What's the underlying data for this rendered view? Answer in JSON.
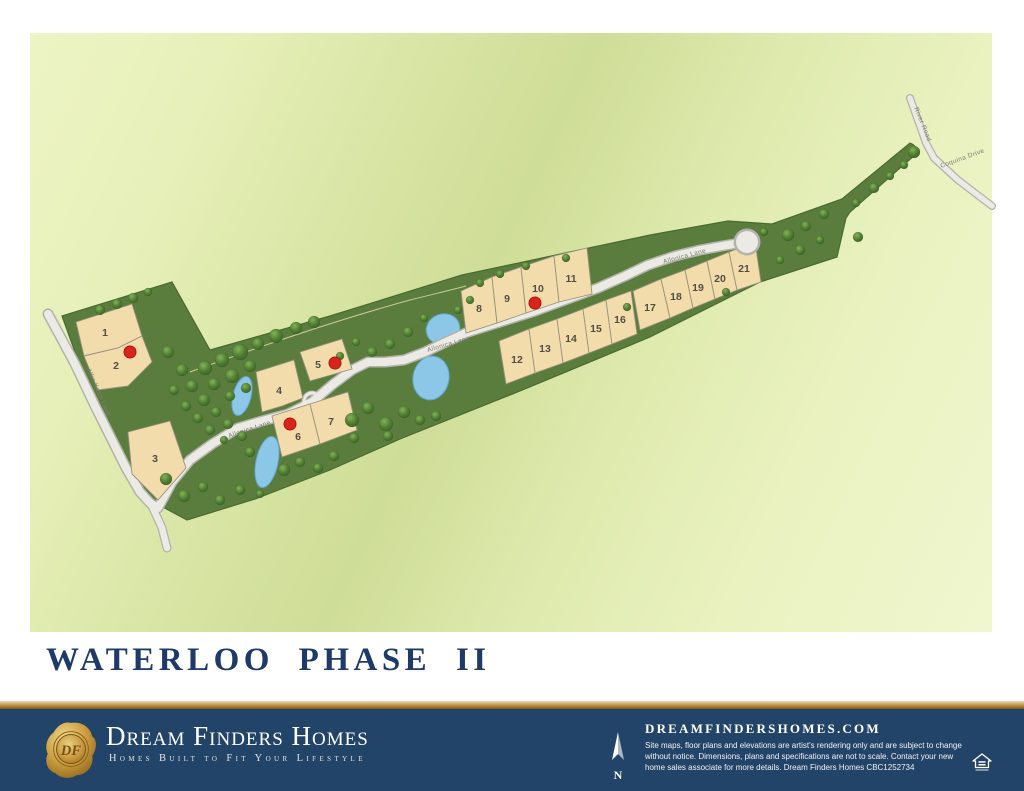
{
  "title": "WATERLOO PHASE II",
  "map": {
    "street_labels": [
      {
        "text": "Allie Koon Lane",
        "x": 97,
        "y": 393,
        "rotate": 66
      },
      {
        "text": "Allonica Lane",
        "x": 250,
        "y": 431,
        "rotate": -18
      },
      {
        "text": "Allonica Lane",
        "x": 449,
        "y": 346,
        "rotate": -16
      },
      {
        "text": "Allonica Lane",
        "x": 685,
        "y": 258,
        "rotate": -15
      },
      {
        "text": "River Road",
        "x": 921,
        "y": 125,
        "rotate": 68
      },
      {
        "text": "Coquina Drive",
        "x": 963,
        "y": 160,
        "rotate": -20
      }
    ],
    "lots": [
      {
        "n": "1",
        "x": 105,
        "y": 336
      },
      {
        "n": "2",
        "x": 116,
        "y": 369,
        "dot": {
          "x": 130,
          "y": 352
        }
      },
      {
        "n": "3",
        "x": 155,
        "y": 462
      },
      {
        "n": "4",
        "x": 279,
        "y": 394
      },
      {
        "n": "5",
        "x": 318,
        "y": 368,
        "dot": {
          "x": 335,
          "y": 363
        }
      },
      {
        "n": "6",
        "x": 298,
        "y": 440,
        "dot": {
          "x": 290,
          "y": 424
        }
      },
      {
        "n": "7",
        "x": 331,
        "y": 425
      },
      {
        "n": "8",
        "x": 479,
        "y": 312
      },
      {
        "n": "9",
        "x": 507,
        "y": 302
      },
      {
        "n": "10",
        "x": 538,
        "y": 292,
        "dot": {
          "x": 535,
          "y": 303
        }
      },
      {
        "n": "11",
        "x": 571,
        "y": 282
      },
      {
        "n": "12",
        "x": 517,
        "y": 363
      },
      {
        "n": "13",
        "x": 545,
        "y": 352
      },
      {
        "n": "14",
        "x": 571,
        "y": 342
      },
      {
        "n": "15",
        "x": 596,
        "y": 332
      },
      {
        "n": "16",
        "x": 620,
        "y": 323
      },
      {
        "n": "17",
        "x": 650,
        "y": 311
      },
      {
        "n": "18",
        "x": 676,
        "y": 300
      },
      {
        "n": "19",
        "x": 698,
        "y": 291
      },
      {
        "n": "20",
        "x": 720,
        "y": 282
      },
      {
        "n": "21",
        "x": 744,
        "y": 272
      }
    ]
  },
  "footer": {
    "brand_name": "Dream Finders Homes",
    "tagline": "Homes Built to Fit Your Lifestyle",
    "monogram": "DF",
    "north_label": "N",
    "website": "DREAMFINDERSHOMES.COM",
    "disclaimer_lines": [
      "Site maps, floor plans and elevations are artist's rendering only and are subject to change",
      "without notice. Dimensions, plans and specifications are not to scale. Contact your new",
      "home sales associate for more details. Dream Finders Homes CBC1252734"
    ]
  },
  "colors": {
    "navy": "#234469",
    "title_navy": "#1D3A68",
    "gold": "#C08F3F",
    "map_background": "#E9F2BD",
    "parcel_green": "#5A7D3E",
    "lot_fill": "#F3DCAB",
    "pond_blue": "#8CC7E8",
    "road_gray": "#ECEAE4",
    "available_dot_red": "#D8251B"
  }
}
